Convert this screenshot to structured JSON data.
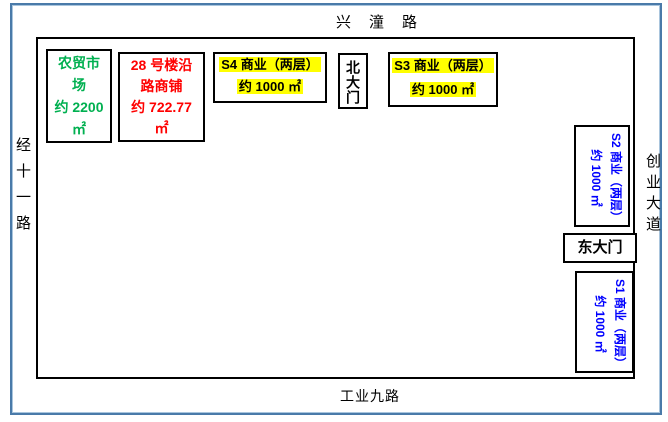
{
  "roads": {
    "north": "兴潼路",
    "west": "经十一路",
    "east": "创业大道",
    "south": "工业九路"
  },
  "buildings": {
    "farmers_market": {
      "text": "农贸市\n场\n约 2200\n㎡",
      "color": "#00B050"
    },
    "shop_28": {
      "text": "28 号楼沿\n路商铺\n约 722.77\n㎡",
      "color": "#FF0000"
    },
    "s4": {
      "line1": "S4 商业（两层）",
      "line2": "约 1000 ㎡",
      "highlight": "#FFFF00"
    },
    "s3": {
      "line1": "S3 商业（两层）",
      "line2": "约 1000 ㎡",
      "highlight": "#FFFF00"
    },
    "s2": {
      "line1": "S2 商业（两层）",
      "line2": "约 1000 ㎡",
      "color": "#0000FF"
    },
    "s1": {
      "line1": "S1 商业（两层）",
      "line2": "约 1000 ㎡",
      "color": "#0000FF"
    },
    "north_gate": {
      "text": "北大门"
    },
    "east_gate": {
      "text": "东大门"
    }
  },
  "colors": {
    "frame_blue": "#4A7AA9",
    "boundary": "#000000",
    "market_green": "#00B050",
    "shop_red": "#FF0000",
    "commerce_blue": "#0000FF",
    "highlight_yellow": "#FFFF00"
  }
}
